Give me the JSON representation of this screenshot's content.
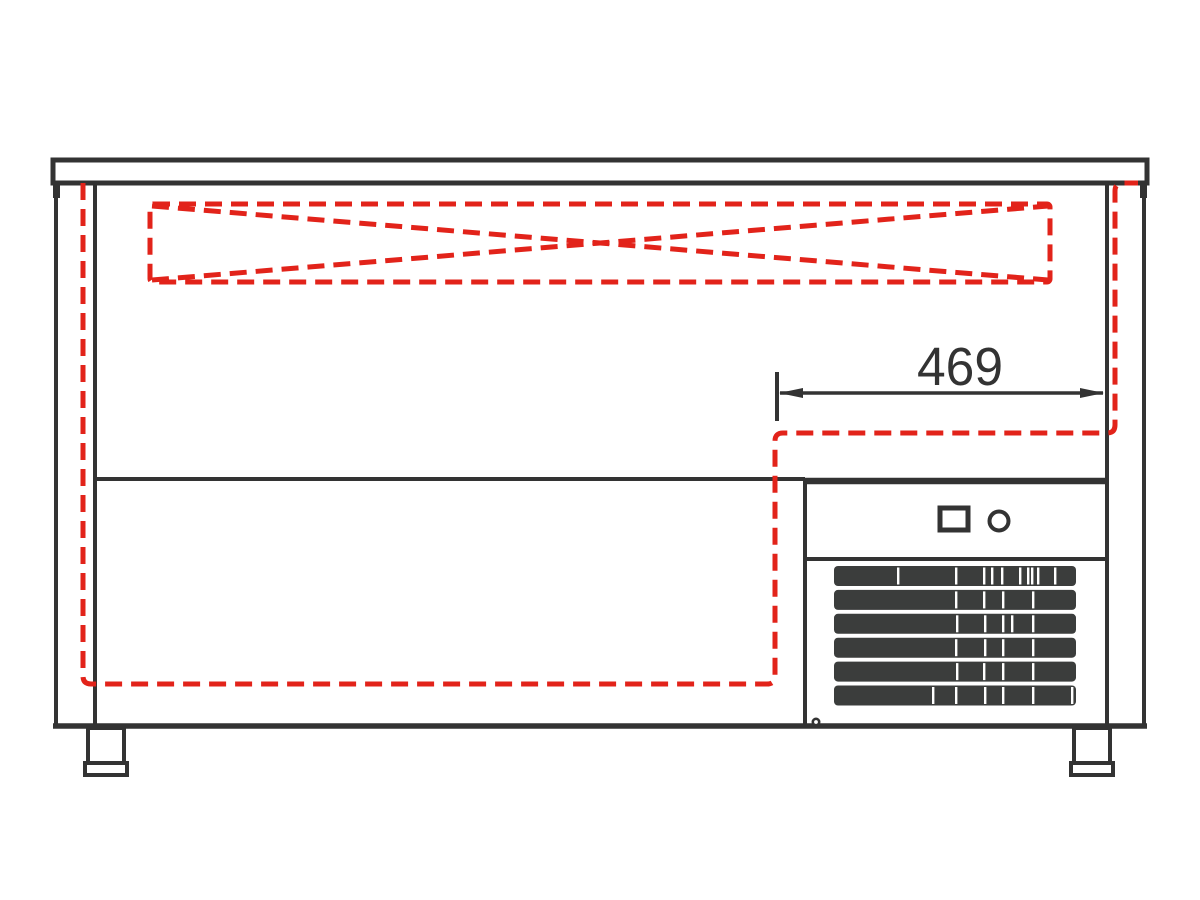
{
  "drawing": {
    "dimension": {
      "label": "469"
    },
    "grille": {
      "bars": 6,
      "columns_x_start": 834,
      "columns_x_end": 1076
    },
    "controls": {
      "switch_count": 1,
      "indicator_lamp_count": 1
    },
    "feet_count": 2,
    "colors": {
      "line": "#333333",
      "hidden_line": "#e2231a",
      "grille_fill": "#3b3d3c",
      "background": "#ffffff"
    }
  }
}
